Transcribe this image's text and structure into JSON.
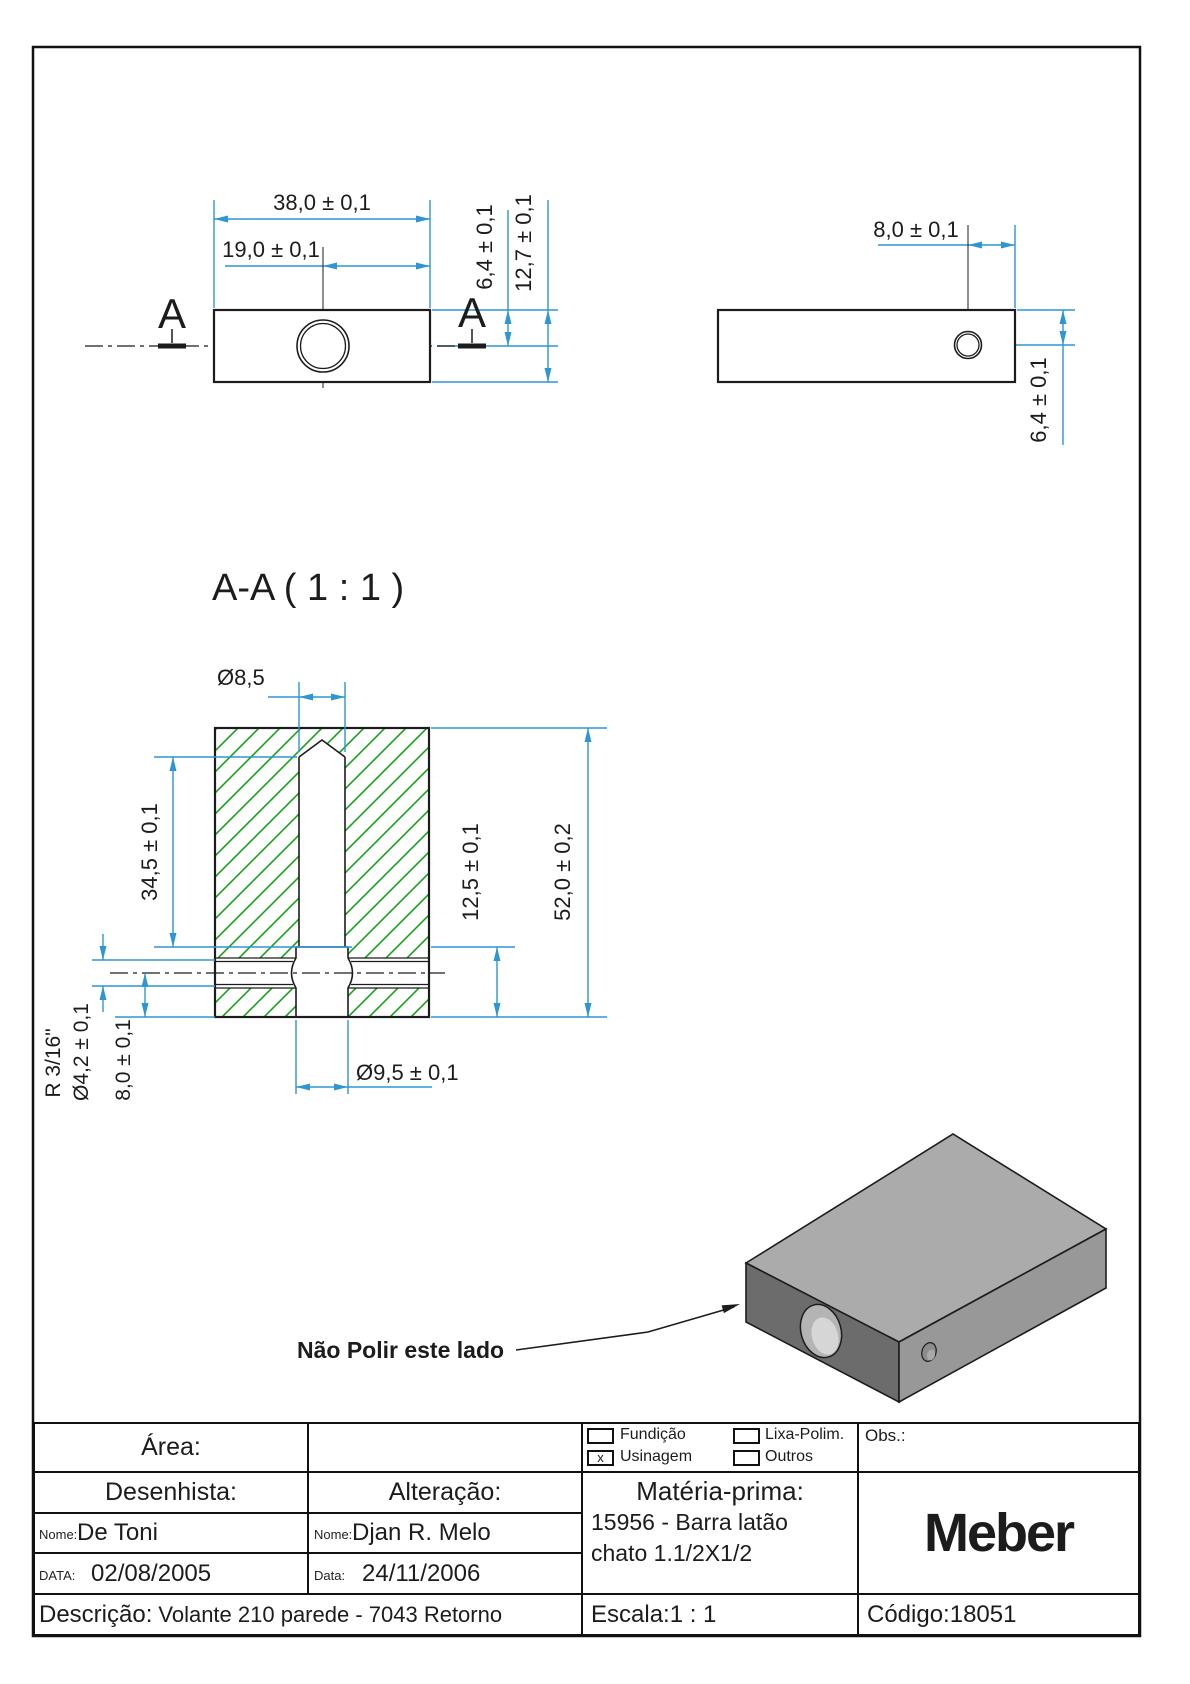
{
  "colors": {
    "dim_blue": "#2e96d0",
    "hatch_green": "#17a317",
    "line_black": "#1c1c1c"
  },
  "annotations": {
    "section_title": "A-A ( 1 : 1 )",
    "section_letter_left": "A",
    "section_letter_right": "A",
    "note": "Não Polir este lado"
  },
  "front_view": {
    "dim_width": "38,0 ± 0,1",
    "dim_center": "19,0 ± 0,1",
    "dim_hole_y": "6,4 ± 0,1",
    "dim_height": "12,7 ± 0,1"
  },
  "side_view": {
    "dim_hole_x": "8,0 ± 0,1",
    "dim_hole_y": "6,4 ± 0,1"
  },
  "section_view": {
    "dim_hole_dia": "Ø8,5",
    "dim_hole_depth": "34,5 ± 0,1",
    "dim_cbore_depth": "12,5 ± 0,1",
    "dim_total_height": "52,0 ± 0,2",
    "dim_cbore_dia": "Ø9,5 ± 0,1",
    "dim_cross_radius": "R 3/16\"",
    "dim_cross_dia": "Ø4,2 ± 0,1",
    "dim_cross_pos": "8,0 ± 0,1"
  },
  "title_block": {
    "area_label": "Área:",
    "desenhista_label": "Desenhista:",
    "alteracao_label": "Alteração:",
    "nome_label": "Nome:",
    "nome_value": "De Toni",
    "alt_nome_label": "Nome:",
    "alt_nome_value": "Djan R. Melo",
    "data_label": "DATA:",
    "data_value": "02/08/2005",
    "alt_data_label": "Data:",
    "alt_data_value": "24/11/2006",
    "descricao_label": "Descrição:",
    "descricao_value": "Volante 210 parede - 7043 Retorno",
    "escala_label": "Escala:",
    "escala_value": "1 : 1",
    "codigo_label": "Código:",
    "codigo_value": "18051",
    "obs_label": "Obs.:",
    "materia_title": "Matéria-prima:",
    "materia_line1": "15956 - Barra latão",
    "materia_line2": "chato 1.1/2X1/2",
    "logo": "Meber",
    "process": {
      "fundicao": "Fundição",
      "lixa": "Lixa-Polim.",
      "usinagem": "Usinagem",
      "outros": "Outros",
      "checked_mark": "x"
    }
  }
}
